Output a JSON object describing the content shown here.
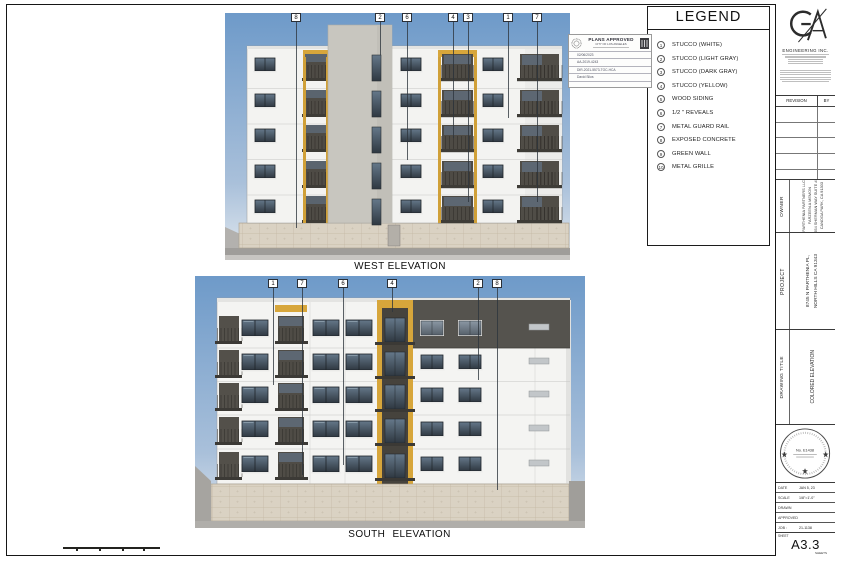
{
  "legend": {
    "title": "LEGEND",
    "items": [
      {
        "num": "1",
        "label": "STUCCO (WHITE)"
      },
      {
        "num": "2",
        "label": "STUCCO (LIGHT GRAY)"
      },
      {
        "num": "3",
        "label": "STUCCO (DARK GRAY)"
      },
      {
        "num": "4",
        "label": "STUCCO (YELLOW)"
      },
      {
        "num": "5",
        "label": "WOOD SIDING"
      },
      {
        "num": "6",
        "label": "1/2 \" REVEALS"
      },
      {
        "num": "7",
        "label": "METAL GUARD RAIL"
      },
      {
        "num": "8",
        "label": "EXPOSED CONCRETE"
      },
      {
        "num": "9",
        "label": "GREEN WALL"
      },
      {
        "num": "10",
        "label": "METAL GRILLE"
      }
    ]
  },
  "approval": {
    "title": "PLANS APPROVED",
    "city": "CITY OF LOS ANGELES",
    "fields": [
      "02/06/2023",
      "AA-2019-4243",
      "DIR-2021-5573-TOC-HCA",
      "David Silva"
    ]
  },
  "elevations": {
    "west": {
      "title": "WEST ELEVATION",
      "callouts": [
        "8",
        "2",
        "6",
        "4",
        "3",
        "1",
        "7"
      ]
    },
    "south": {
      "title": "SOUTH ELEVATION",
      "callouts": [
        "1",
        "7",
        "6",
        "4",
        "2",
        "8"
      ]
    }
  },
  "titleblock": {
    "firm_name": "ENGINEERING INC.",
    "revision_col": "REVISION",
    "by_col": "BY",
    "owner_label": "OWNER",
    "owner_lines": [
      "PARTHENIA PARTNERS LLC",
      "FARZEEN A MEMON",
      "21654 SHERMAN WAY SUITE #203",
      "CANOGA PARK, CA 91303"
    ],
    "project_label": "PROJECT",
    "project_lines": [
      "8745 N PARTHENIA PL,",
      "NORTH HILLS CA 91343"
    ],
    "drawing_title_label": "DRAWING TITLE",
    "drawing_title": "COLORED ELEVATION",
    "stamp_no": "No. E1438",
    "info_rows": [
      {
        "label": "DATE",
        "value": "JAN 5, 23"
      },
      {
        "label": "SCALE",
        "value": "1/8\"=1'-0\""
      },
      {
        "label": "DRAWN",
        "value": ""
      },
      {
        "label": "APPROVED",
        "value": ""
      },
      {
        "label": "JOB :",
        "value": "21-1138"
      }
    ],
    "sheet_label": "SHEET",
    "sheet_number": "A3.3",
    "sheets_note": "SHEETS"
  },
  "colors": {
    "stucco_white": "#f3f3f1",
    "stucco_light_gray": "#c8c6bf",
    "stucco_dark_gray": "#55534e",
    "stucco_yellow": "#d7a63b",
    "sky_top": "#6e9ac9",
    "concrete": "#dad2c3"
  }
}
